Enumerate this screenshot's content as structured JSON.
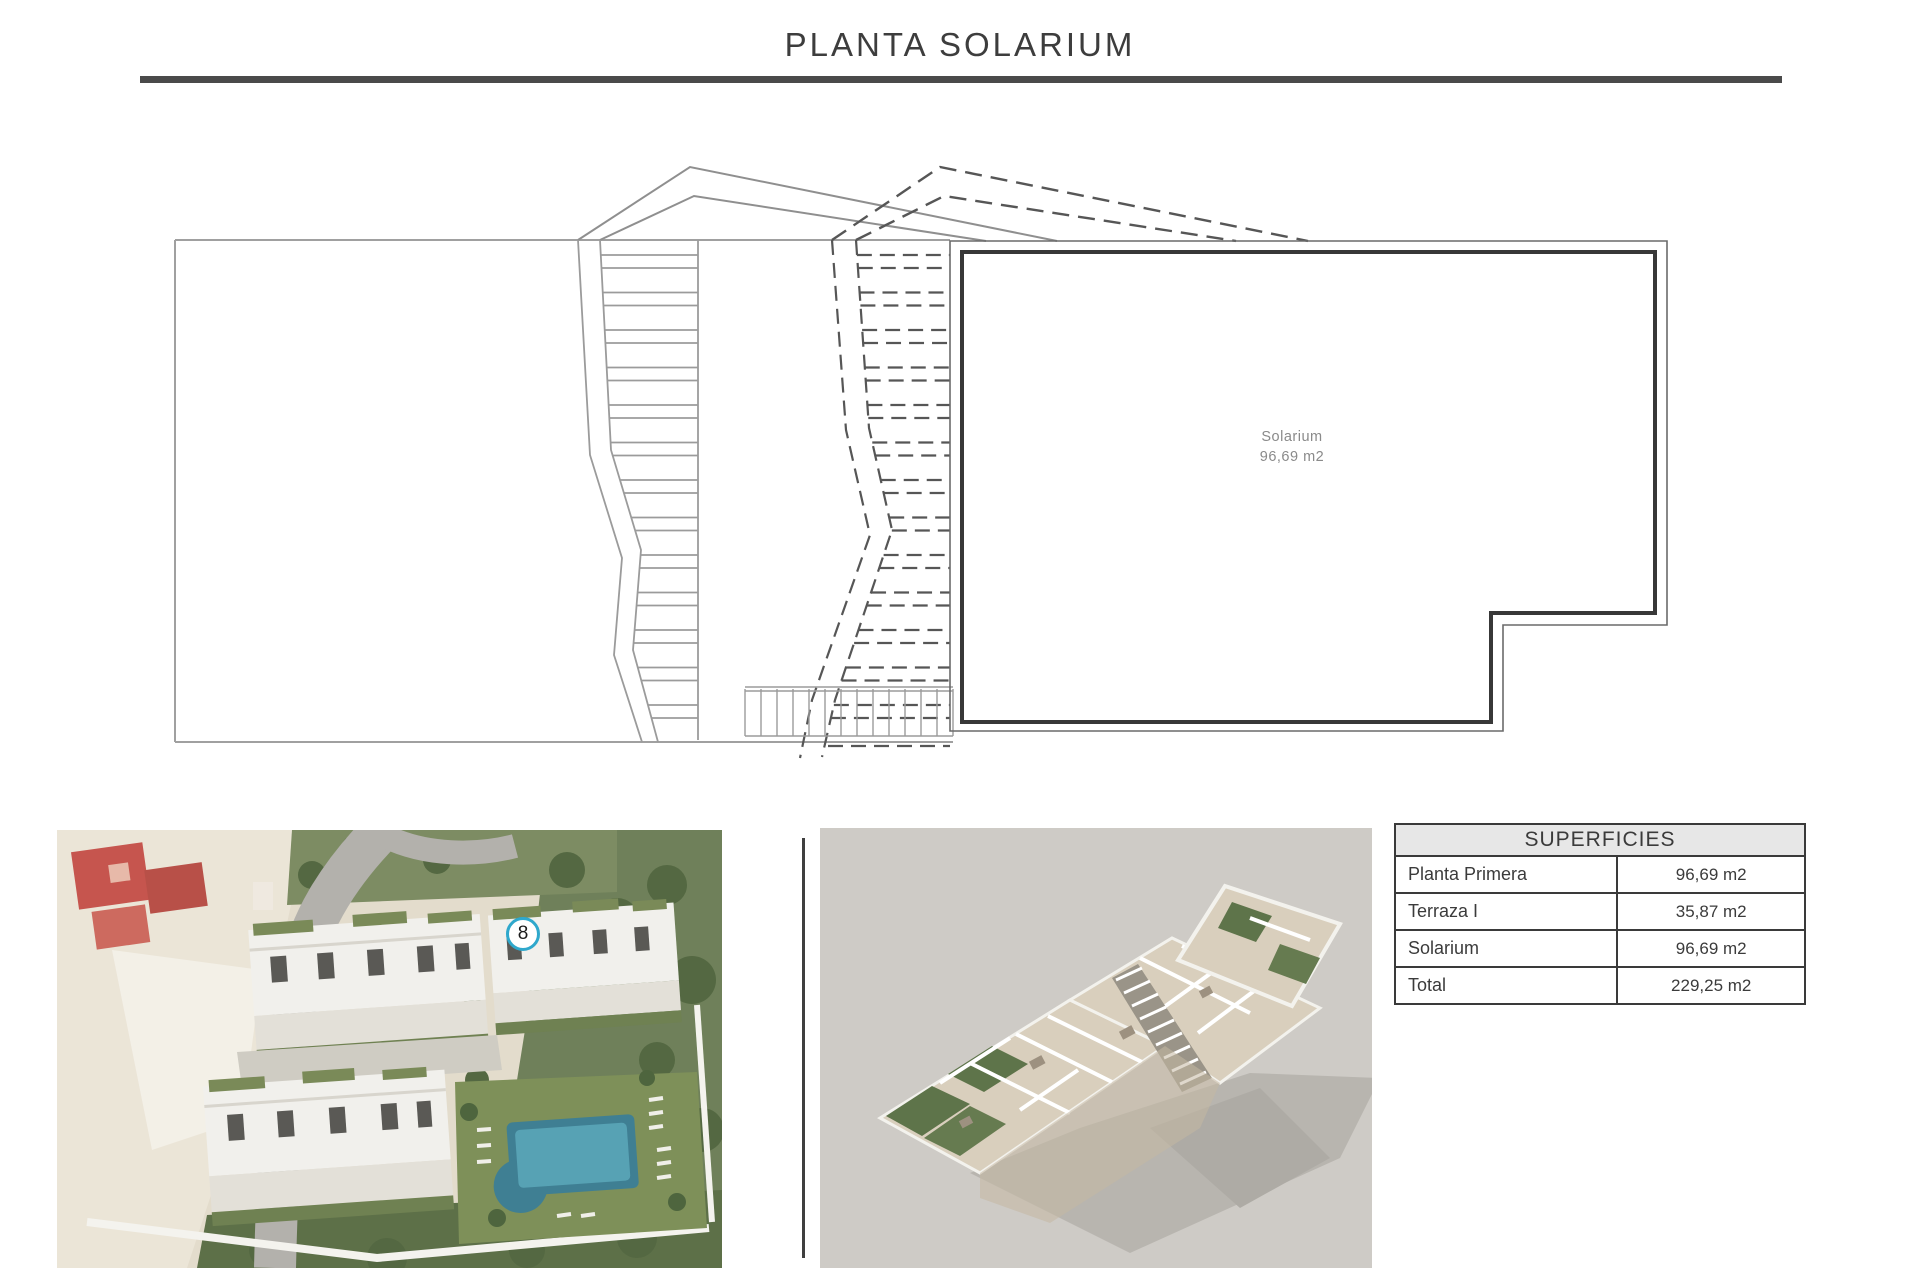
{
  "page": {
    "title": "PLANTA SOLARIUM"
  },
  "plan": {
    "room": {
      "name": "Solarium",
      "area": "96,69 m2"
    }
  },
  "aerial_photo": {
    "marker_number": "8"
  },
  "superficies_table": {
    "header": "SUPERFICIES",
    "rows": [
      {
        "label": "Planta Primera",
        "value": "96,69 m2"
      },
      {
        "label": "Terraza I",
        "value": "35,87 m2"
      },
      {
        "label": "Solarium",
        "value": "96,69 m2"
      },
      {
        "label": "Total",
        "value": "229,25 m2"
      }
    ]
  },
  "colors": {
    "marker_accent": "#2fa8cc",
    "bold_wall": "#383838",
    "thin_wall": "#6a6a6a",
    "boundary_gray": "#a0a0a0",
    "dashed_line": "#565656",
    "table_header_bg": "#e7e7e7",
    "title_rule": "#4a4a4a"
  }
}
